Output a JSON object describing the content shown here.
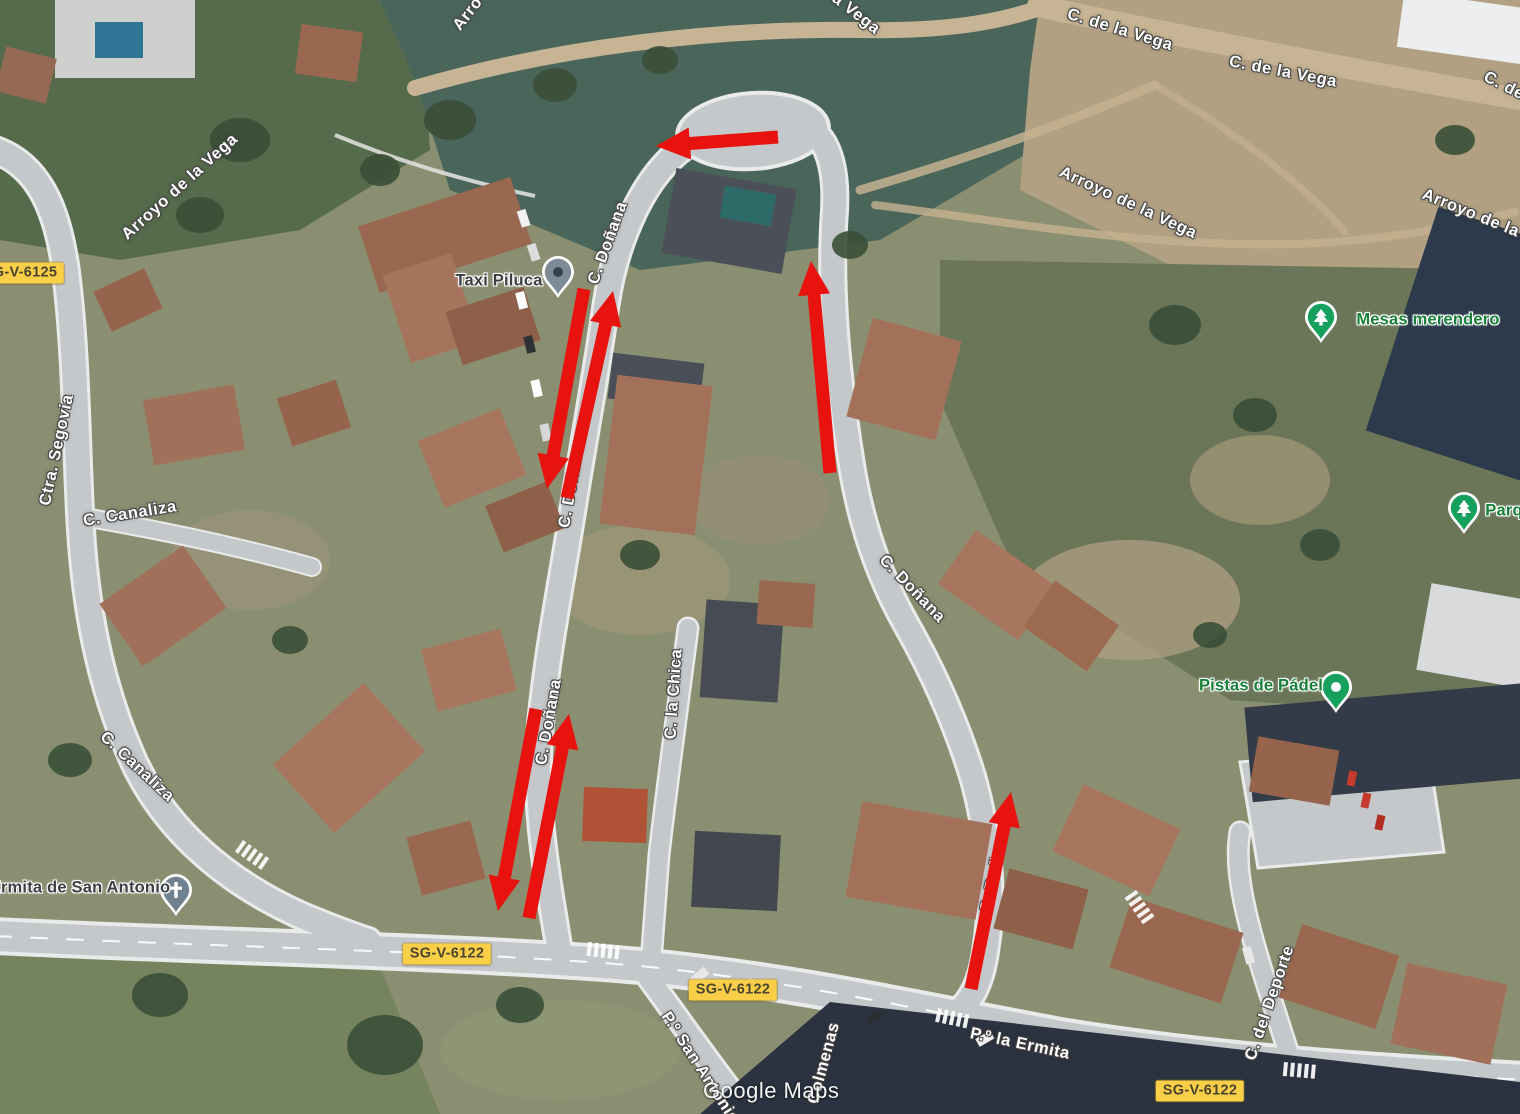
{
  "map": {
    "watermark": "Google Maps"
  },
  "colors": {
    "arrow": "#e8120e",
    "badge_bg": "#f8cf46",
    "badge_text": "#4a4431",
    "poi_green": "#188038",
    "poi_dark": "#3c4043",
    "street_label": "#ffffff"
  },
  "road_badges": [
    {
      "label": "SG-V-6125",
      "x": 20,
      "y": 273
    },
    {
      "label": "SG-V-6122",
      "x": 447,
      "y": 954
    },
    {
      "label": "SG-V-6122",
      "x": 733,
      "y": 990
    },
    {
      "label": "SG-V-6122",
      "x": 1200,
      "y": 1091
    }
  ],
  "street_labels": [
    {
      "text": "Arro",
      "x": 468,
      "y": 14,
      "rot": -52
    },
    {
      "text": "a Vega",
      "x": 856,
      "y": 14,
      "rot": 38
    },
    {
      "text": "C. de la Vega",
      "x": 1120,
      "y": 30,
      "rot": 17
    },
    {
      "text": "C. de la Vega",
      "x": 1283,
      "y": 72,
      "rot": 11
    },
    {
      "text": "C. de",
      "x": 1504,
      "y": 86,
      "rot": 27
    },
    {
      "text": "Arroyo de la Vega",
      "x": 180,
      "y": 187,
      "rot": -42
    },
    {
      "text": "Arroyo de la Vega",
      "x": 1128,
      "y": 203,
      "rot": 25
    },
    {
      "text": "Arroyo de la Vega",
      "x": 1492,
      "y": 222,
      "rot": 22
    },
    {
      "text": "Ctra. Segovia",
      "x": 57,
      "y": 450,
      "rot": -78
    },
    {
      "text": "C. Canaliza",
      "x": 130,
      "y": 514,
      "rot": -9
    },
    {
      "text": "C. Canaliza",
      "x": 137,
      "y": 767,
      "rot": 43
    },
    {
      "text": "C. Doñana",
      "x": 608,
      "y": 243,
      "rot": -70
    },
    {
      "text": "C. Doñana",
      "x": 572,
      "y": 485,
      "rot": -80
    },
    {
      "text": "C. Doñana",
      "x": 549,
      "y": 722,
      "rot": -80
    },
    {
      "text": "C. Doñana",
      "x": 912,
      "y": 589,
      "rot": 46
    },
    {
      "text": "C. Doñana",
      "x": 995,
      "y": 870,
      "rot": -78
    },
    {
      "text": "C. la Chica",
      "x": 674,
      "y": 694,
      "rot": -86
    },
    {
      "text": "P.º San Antonio",
      "x": 700,
      "y": 1068,
      "rot": 57
    },
    {
      "text": "P.º la Ermita",
      "x": 1020,
      "y": 1044,
      "rot": 12
    },
    {
      "text": "C. del Deporte",
      "x": 1270,
      "y": 1003,
      "rot": -71
    },
    {
      "text": "Colmenas",
      "x": 824,
      "y": 1063,
      "rot": -75
    }
  ],
  "pois": [
    {
      "name": "taxi-piluca",
      "label": "Taxi Piluca",
      "label_style": "dark",
      "pin": "dot-dark",
      "pin_color": "#7d8b96",
      "pin_x": 558,
      "pin_y": 272,
      "label_x": 499,
      "label_y": 281
    },
    {
      "name": "mesas-merendero",
      "label": "Mesas merendero",
      "label_style": "green",
      "pin": "tree",
      "pin_color": "#16a05d",
      "pin_x": 1321,
      "pin_y": 317,
      "label_x": 1428,
      "label_y": 320
    },
    {
      "name": "parque",
      "label": "Parq",
      "label_style": "green",
      "pin": "tree",
      "pin_color": "#16a05d",
      "pin_x": 1464,
      "pin_y": 508,
      "label_x": 1504,
      "label_y": 511
    },
    {
      "name": "pistas-de-padel",
      "label": "Pistas de Pádel",
      "label_style": "green",
      "pin": "dot-white",
      "pin_color": "#16a05d",
      "pin_x": 1336,
      "pin_y": 687,
      "label_x": 1261,
      "label_y": 686
    },
    {
      "name": "ermita-de-san-antonio",
      "label": "Ermita de San Antonio",
      "label_style": "dark",
      "pin": "cross",
      "pin_color": "#70828f",
      "pin_x": 176,
      "pin_y": 890,
      "label_x": 80,
      "label_y": 888
    }
  ],
  "annotations": {
    "arrows": [
      {
        "x1": 778,
        "y1": 137,
        "x2": 656,
        "y2": 146
      },
      {
        "x1": 830,
        "y1": 473,
        "x2": 811,
        "y2": 261
      },
      {
        "x1": 584,
        "y1": 289,
        "x2": 547,
        "y2": 489
      },
      {
        "x1": 567,
        "y1": 498,
        "x2": 613,
        "y2": 291
      },
      {
        "x1": 536,
        "y1": 709,
        "x2": 498,
        "y2": 911
      },
      {
        "x1": 529,
        "y1": 918,
        "x2": 569,
        "y2": 714
      },
      {
        "x1": 971,
        "y1": 989,
        "x2": 1011,
        "y2": 792
      }
    ]
  }
}
